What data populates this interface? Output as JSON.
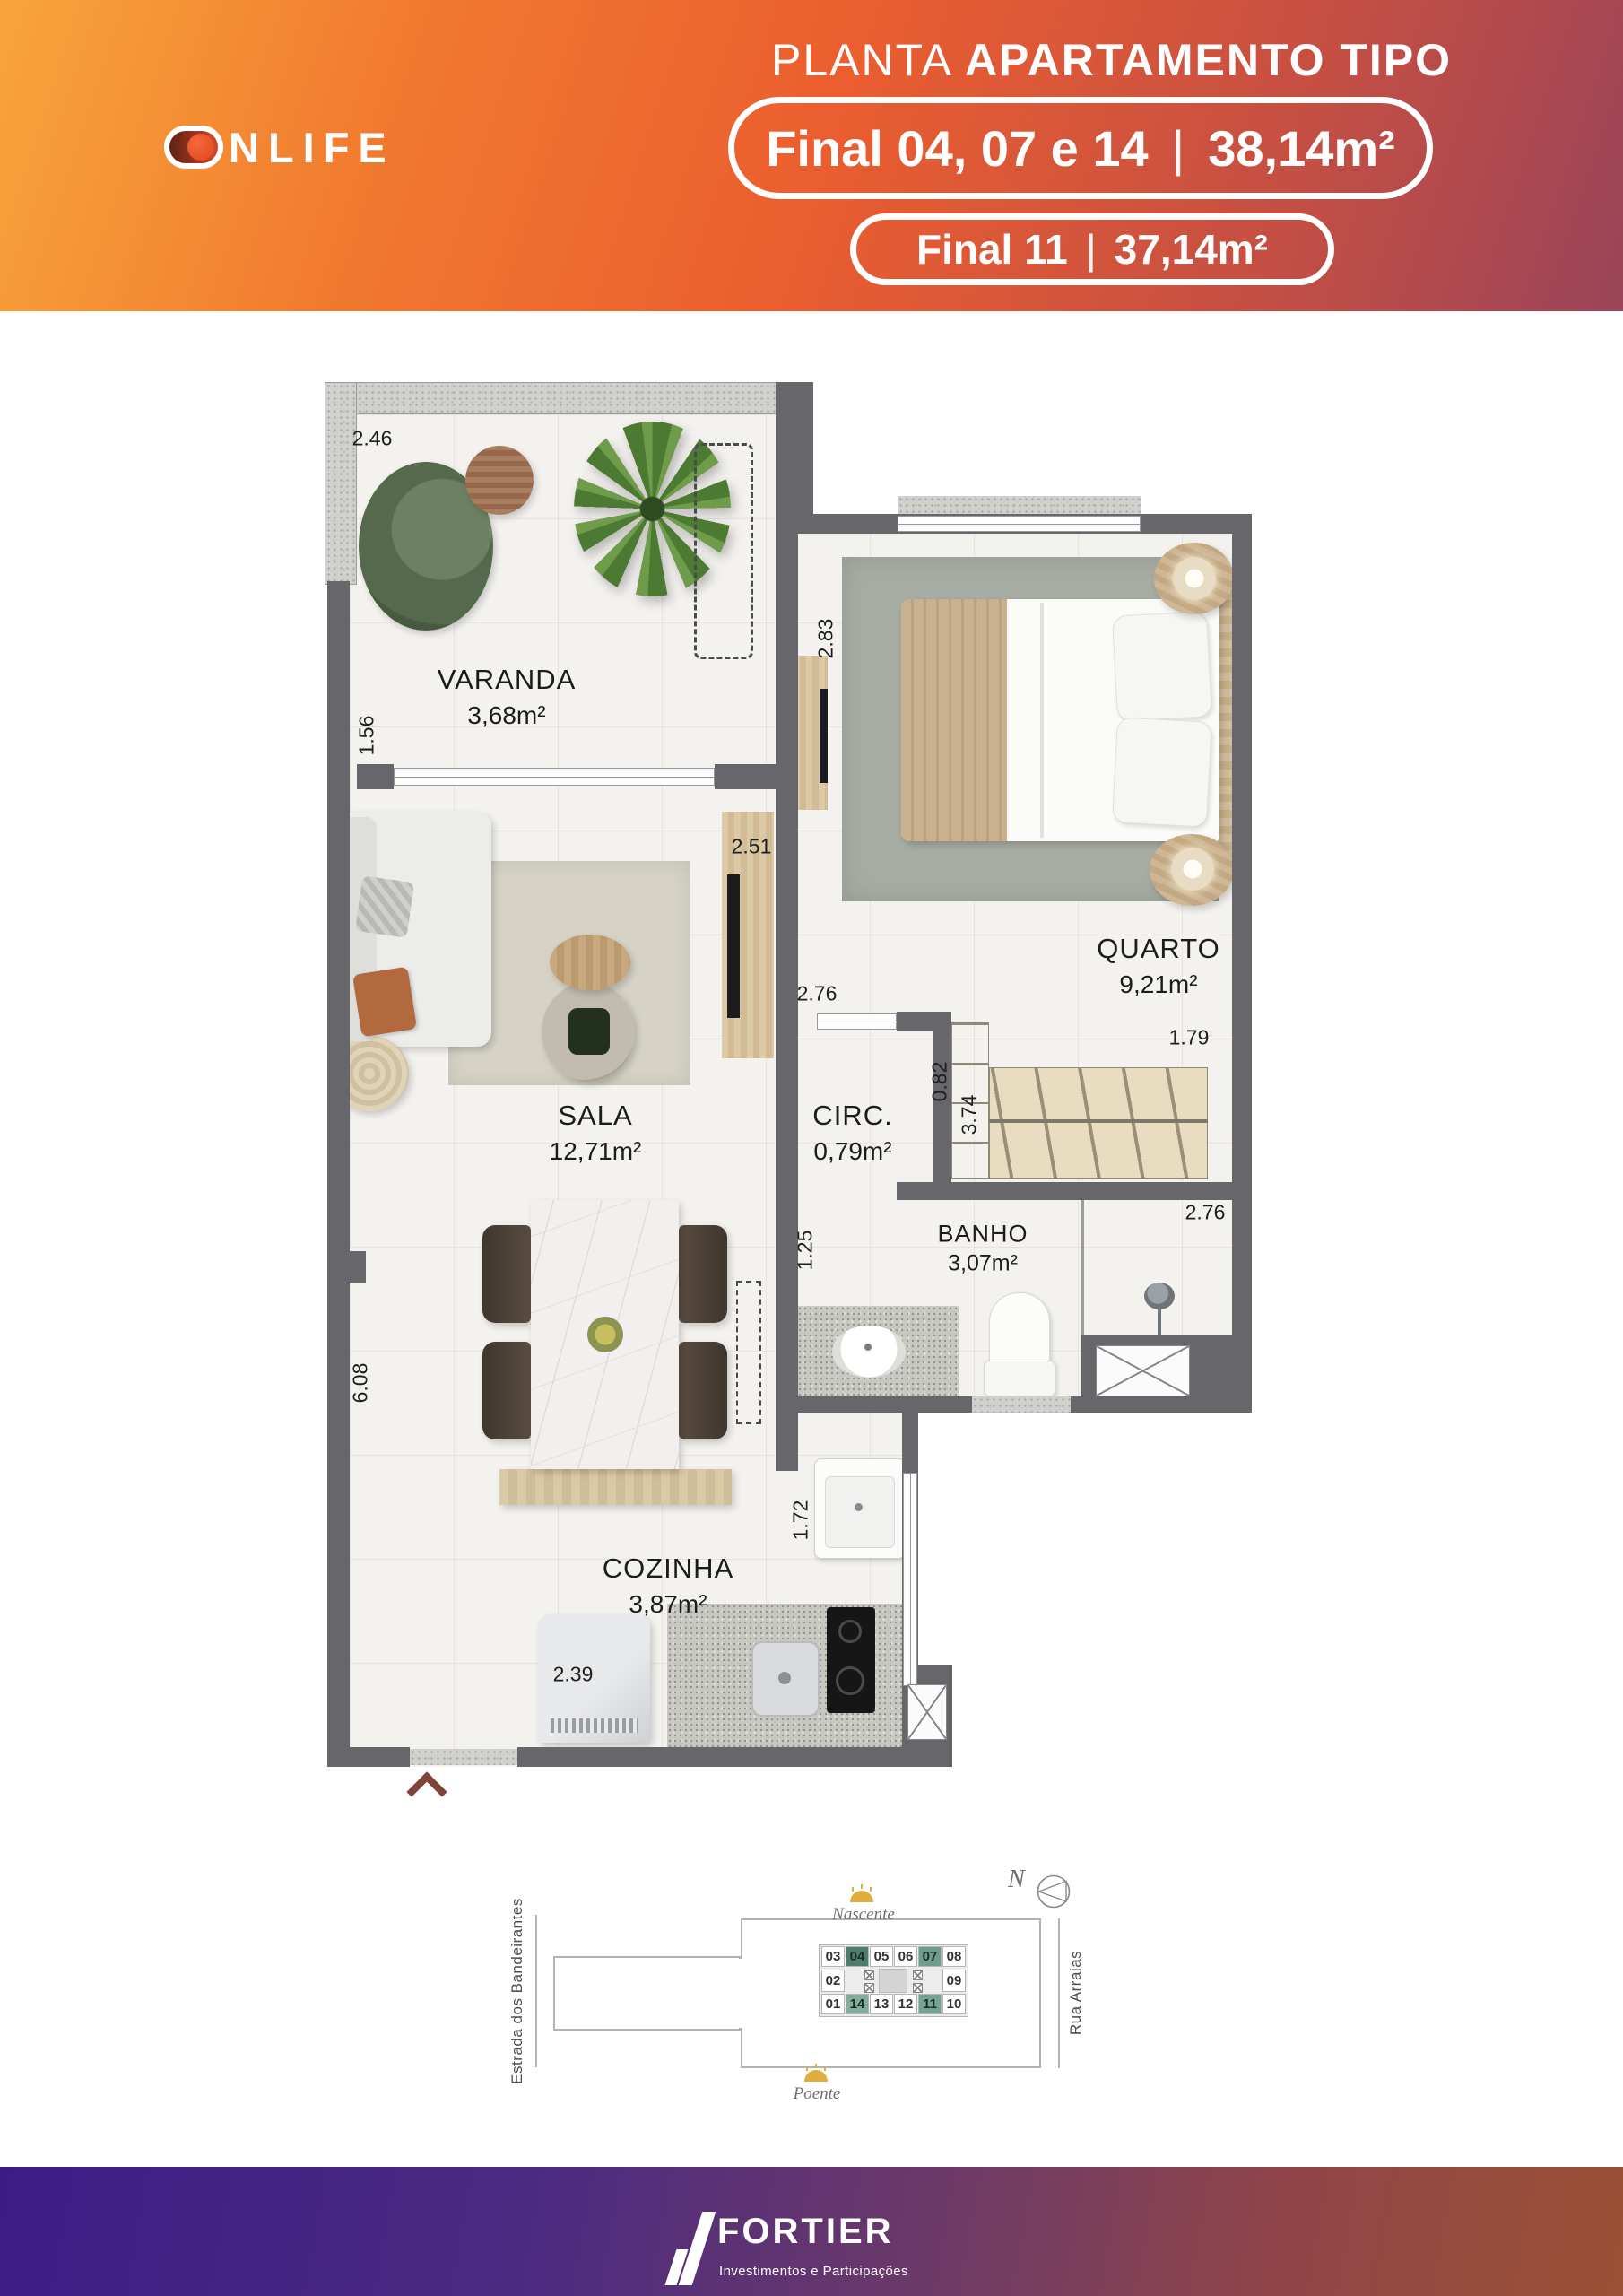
{
  "header": {
    "brand": "ONLIFE",
    "logo_text": "NLIFE",
    "title": {
      "regular": "PLANTA",
      "bold": "APARTAMENTO TIPO"
    },
    "badges": [
      {
        "label": "Final 04, 07 e 14",
        "divider": "|",
        "area": "38,14m²"
      },
      {
        "label": "Final 11",
        "divider": "|",
        "area": "37,14m²"
      }
    ]
  },
  "plan": {
    "rooms": [
      {
        "name": "VARANDA",
        "area": "3,68m²"
      },
      {
        "name": "QUARTO",
        "area": "9,21m²"
      },
      {
        "name": "SALA",
        "area": "12,71m²"
      },
      {
        "name": "CIRC.",
        "area": "0,79m²"
      },
      {
        "name": "BANHO",
        "area": "3,07m²"
      },
      {
        "name": "COZINHA",
        "area": "3,87m²"
      }
    ],
    "dims": {
      "varanda_w": "2.46",
      "varanda_h": "1.56",
      "quarto_h": "2.83",
      "tv_wall": "2.51",
      "circ_w": "2.76",
      "circ_h": "0.82",
      "quarto_w": "1.79",
      "closet_h": "3.74",
      "banho_door": "1.25",
      "banho_w": "2.76",
      "sala_h": "6.08",
      "serv_h": "1.72",
      "cozinha_w": "2.39"
    }
  },
  "site": {
    "streets": {
      "left": "Estrada dos Bandeirantes",
      "right": "Rua Arraias"
    },
    "sun": {
      "top": "Nascente",
      "bottom": "Poente"
    },
    "compass": "N",
    "units_top": [
      "03",
      "04",
      "05",
      "06",
      "07",
      "08"
    ],
    "units_mid": [
      "02",
      "09"
    ],
    "units_bottom": [
      "01",
      "14",
      "13",
      "12",
      "11",
      "10"
    ]
  },
  "footer": {
    "brand": "FORTIER",
    "tagline": "Investimentos e Participações"
  },
  "colors": {
    "accent_orange": "#ed6a2f",
    "accent_purple": "#3c1d86",
    "wall_gray": "#66666b",
    "highlight_dark_green": "#4f7d6d",
    "highlight_green": "#74a392"
  }
}
